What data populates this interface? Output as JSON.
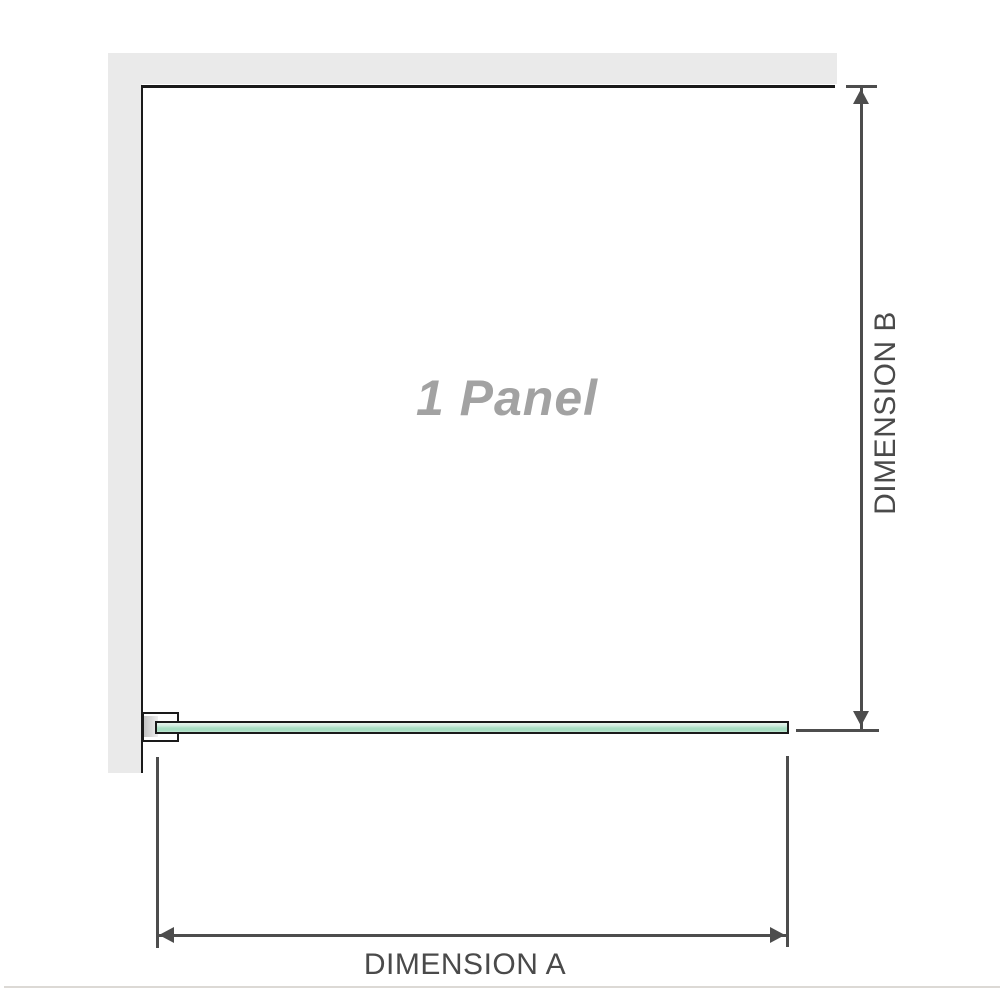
{
  "diagram": {
    "panel_label": "1 Panel",
    "dimensions": {
      "a_label": "DIMENSION A",
      "b_label": "DIMENSION B"
    }
  },
  "colors": {
    "wall": "#eaeaea",
    "outline": "#1a1a1a",
    "dimension_line": "#4d4d4d",
    "dimension_text": "#4a4a4a",
    "panel_label_text": "#a2a2a2",
    "glass_green": "#a6ddc1",
    "glass_green_light": "#d2ecdf",
    "separator": "#dcd9d5"
  }
}
